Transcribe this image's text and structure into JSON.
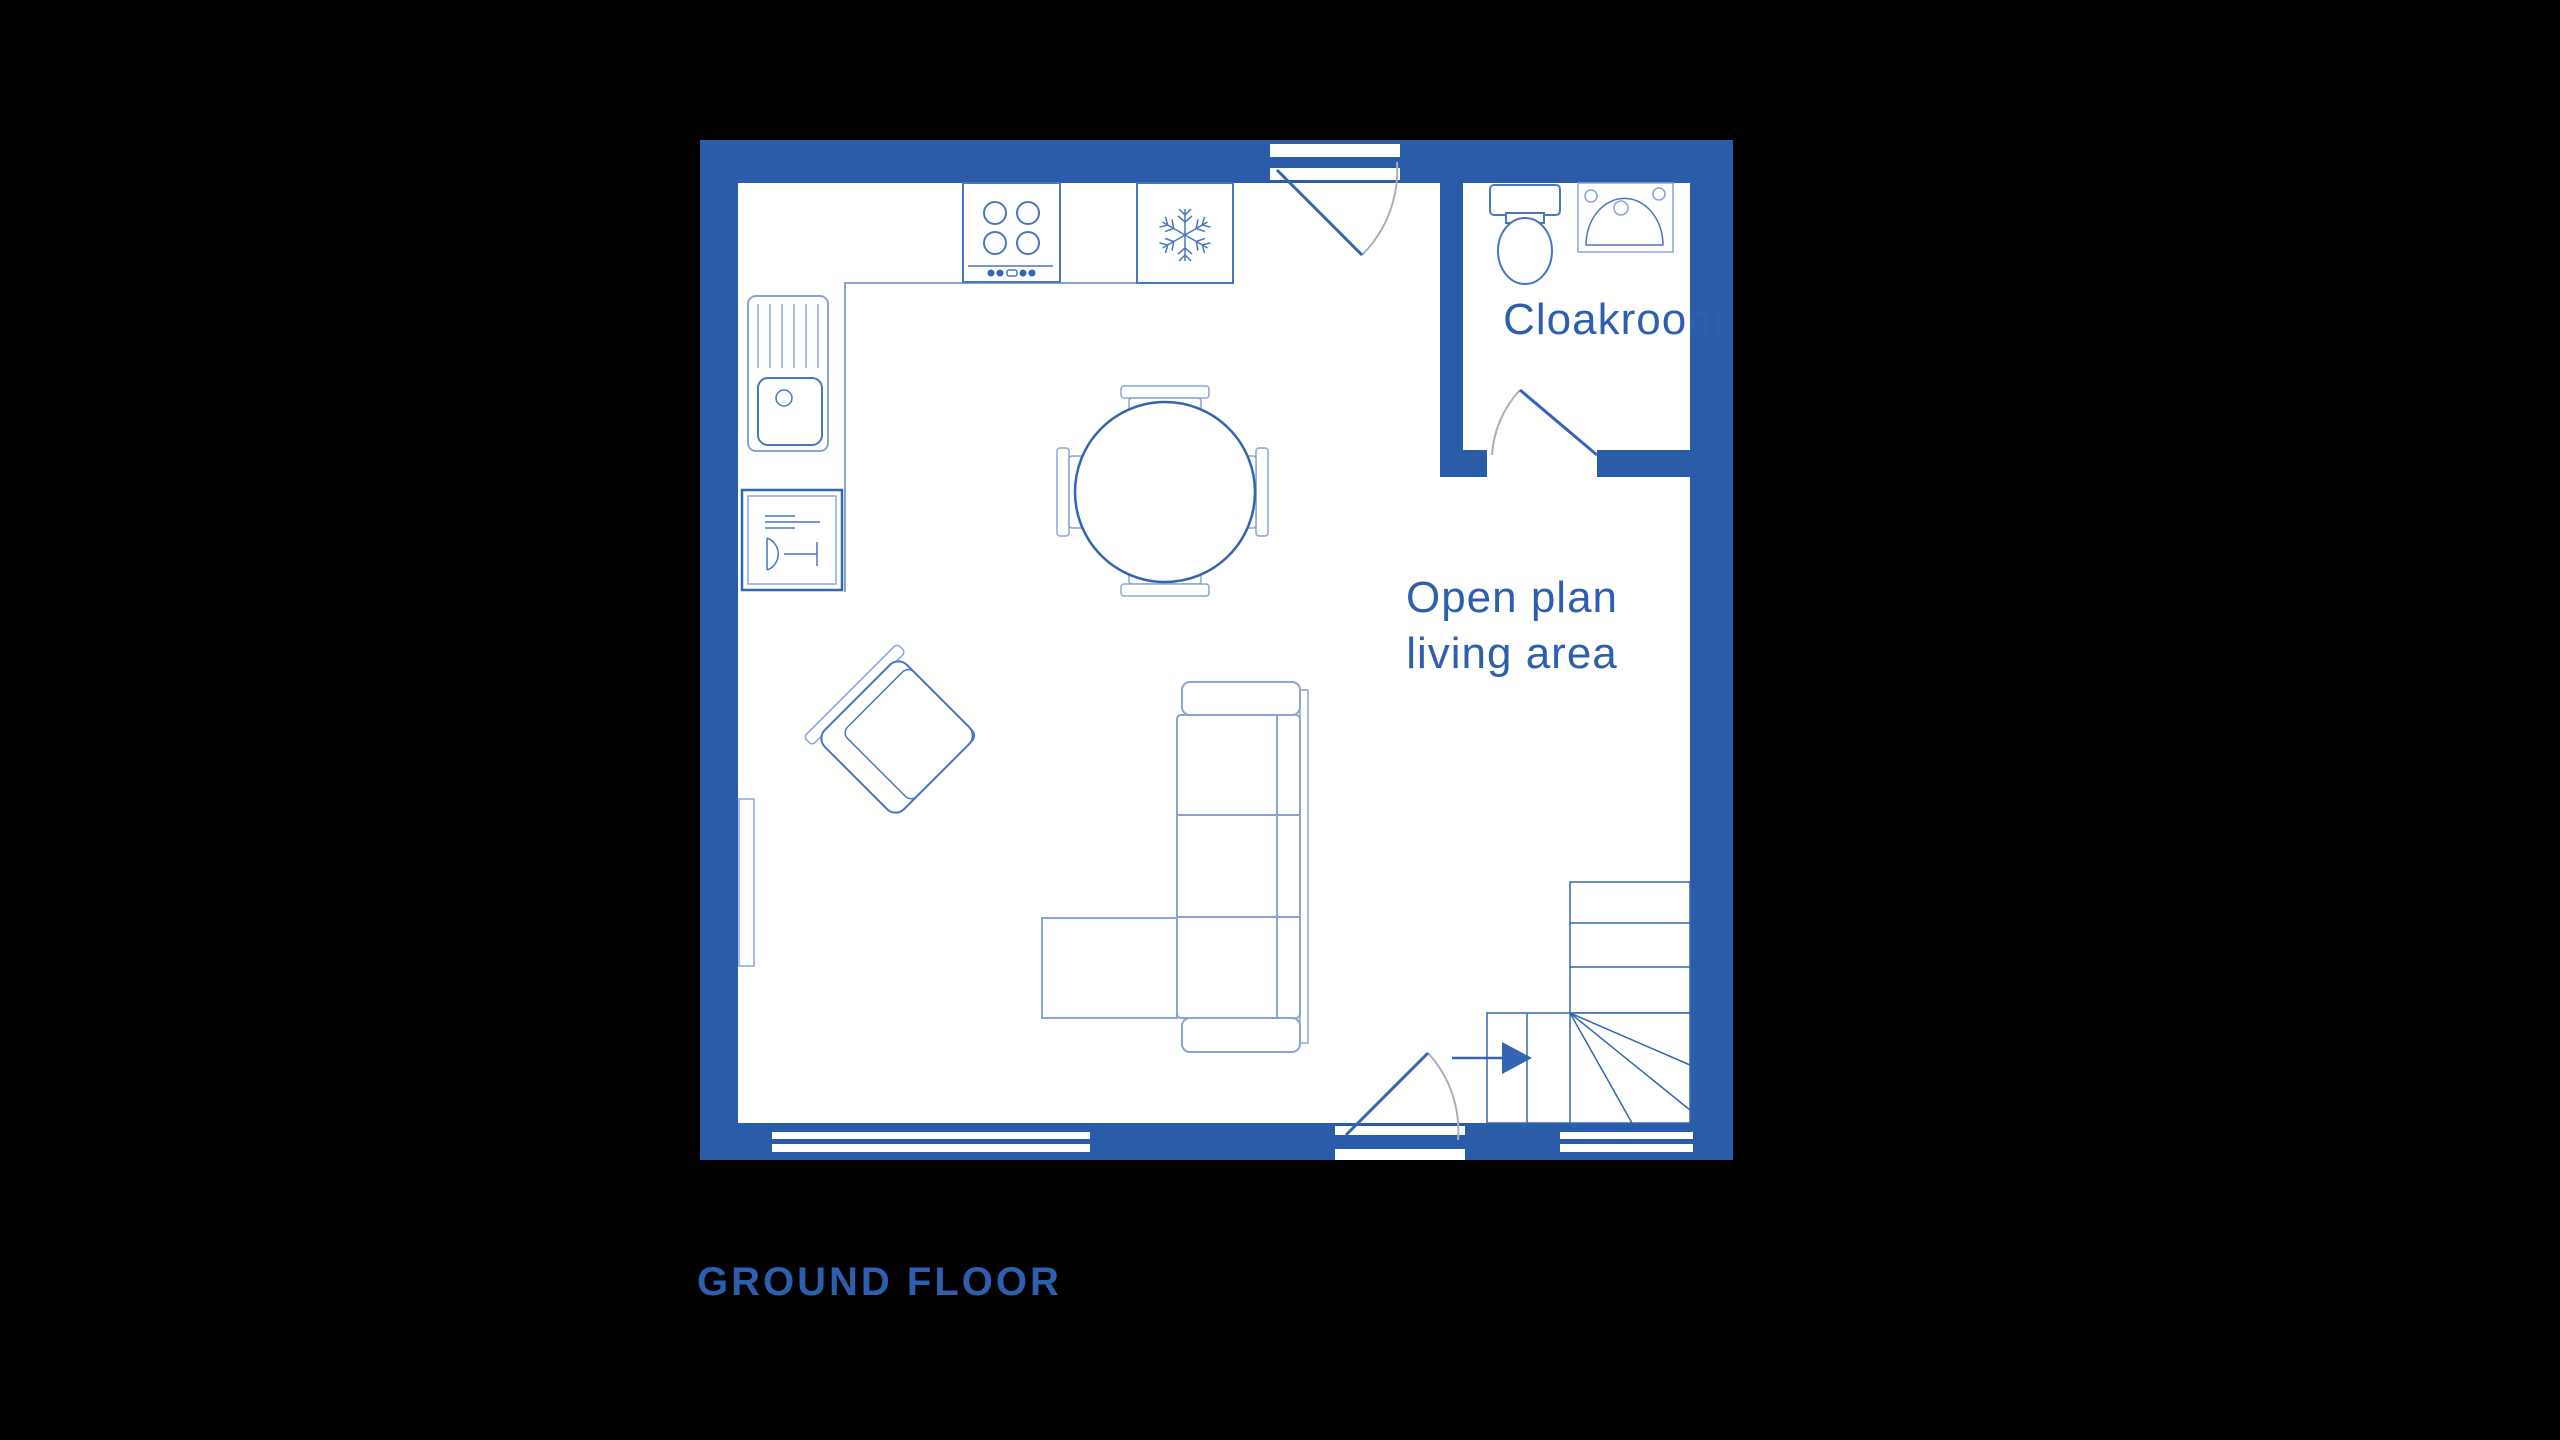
{
  "colors": {
    "background": "#000000",
    "floor": "#ffffff",
    "wall": "#2b5ca9",
    "label_text": "#2d5fae",
    "line_light": "#8aa3d5",
    "line_medium": "#4a76c1",
    "line_strong": "#3465b2",
    "door_arc": "#a9afb8"
  },
  "plan": {
    "floor_label": "GROUND FLOOR",
    "rooms": {
      "open_plan": {
        "label_line1": "Open plan",
        "label_line2": "living area"
      },
      "cloakroom": {
        "label": "Cloakroom"
      }
    },
    "fixtures": [
      "hob",
      "fridge-freezer",
      "sink-with-drainer",
      "dishwasher",
      "radiator",
      "dining-table-4-chairs",
      "armchair",
      "corner-sofa",
      "ottoman",
      "toilet",
      "washbasin",
      "winder-staircase",
      "entrance-door",
      "back-door",
      "cloakroom-door",
      "windows"
    ]
  }
}
